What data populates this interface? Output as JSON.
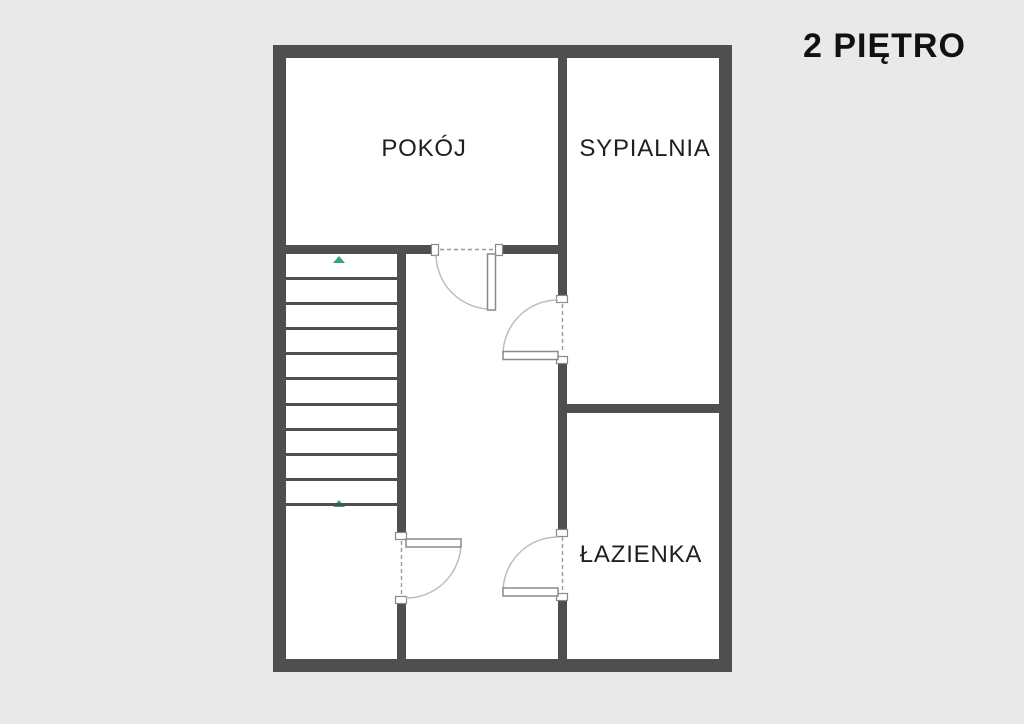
{
  "title": "2 PIĘTRO",
  "plan": {
    "rooms": [
      {
        "id": "pokoj",
        "label": "POKÓJ"
      },
      {
        "id": "sypialnia",
        "label": "SYPIALNIA"
      },
      {
        "id": "lazienka",
        "label": "ŁAZIENKA"
      }
    ],
    "stairs": {
      "step_lines": 10,
      "arrow_count": 2,
      "arrow_direction": "up"
    },
    "door_count": 4,
    "colors": {
      "background": "#e9e9e9",
      "wall": "#4f4f4f",
      "room_fill": "#ffffff",
      "door_line": "#8a8a8a",
      "door_arc": "#bdbdbd",
      "stair_line": "#4f4f4f",
      "arrow_green": "#35a284",
      "label_text": "#1f1f1f",
      "title_text": "#111111"
    }
  }
}
